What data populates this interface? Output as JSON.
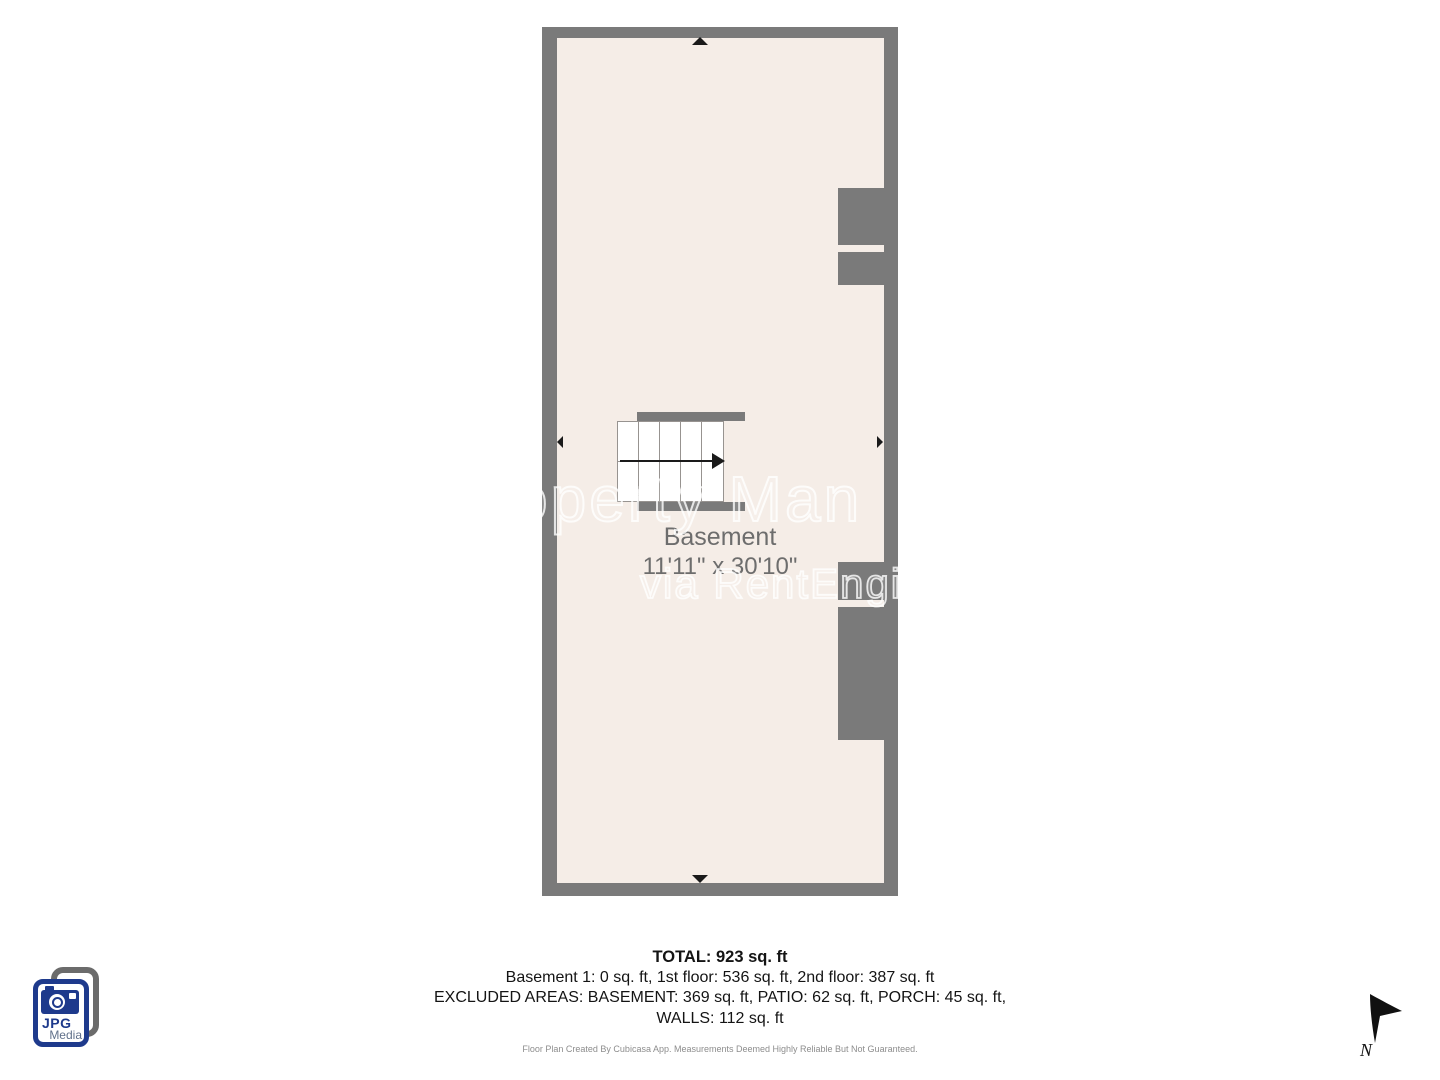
{
  "plan": {
    "room_name": "Basement",
    "room_dimensions": "11'11\" x 30'10\""
  },
  "watermark": {
    "line1": "operty Man",
    "line2": "via RentEngin"
  },
  "summary": {
    "total": "TOTAL: 923 sq. ft",
    "floors": "Basement 1: 0 sq. ft, 1st floor: 536 sq. ft, 2nd floor: 387 sq. ft",
    "excluded": "EXCLUDED AREAS: BASEMENT: 369 sq. ft, PATIO: 62 sq. ft, PORCH: 45 sq. ft,",
    "walls": "WALLS: 112 sq. ft"
  },
  "disclaimer": "Floor Plan Created By Cubicasa App. Measurements Deemed Highly Reliable But Not Guaranteed.",
  "logo": {
    "title": "JPG",
    "subtitle": "Media"
  },
  "compass": {
    "label": "N"
  },
  "colors": {
    "wall_gray": "#7a7a7a",
    "floor_beige": "#f5ede7",
    "room_label_gray": "#6d6d6d",
    "logo_blue": "#1e3a8c",
    "logo_back_gray": "#6b6b6b",
    "arrow_black": "#1a1a1a"
  }
}
